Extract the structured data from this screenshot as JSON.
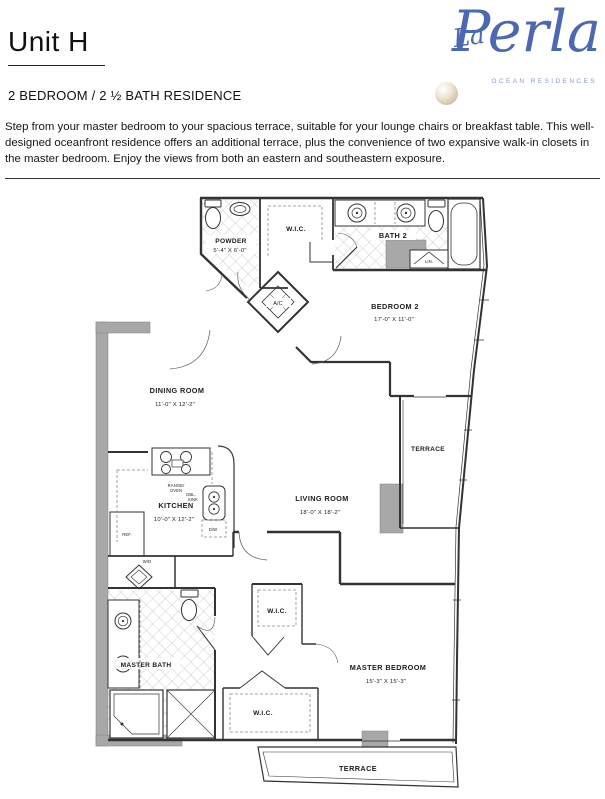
{
  "header": {
    "unit_title": "Unit H",
    "subtitle": "2 BEDROOM / 2 ½ BATH RESIDENCE",
    "description": "Step from your master bedroom to your spacious terrace, suitable for your lounge chairs or breakfast table. This well-designed oceanfront residence offers an additional terrace, plus the convenience of two expansive walk-in closets in the master bedroom. Enjoy the views from both an eastern and southeastern exposure."
  },
  "logo": {
    "script_la": "La",
    "script_perla": "Perla",
    "tagline": "OCEAN RESIDENCES",
    "brand_color": "#4c68b0",
    "pearl_color": "#d4c6b0"
  },
  "floorplan": {
    "rooms": {
      "powder": {
        "name": "POWDER",
        "dims": "5'-4\" X 6'-0\""
      },
      "wic_top": {
        "name": "W.I.C."
      },
      "bath2": {
        "name": "BATH 2"
      },
      "lin": {
        "name": "LIN."
      },
      "ac": {
        "name": "A/C"
      },
      "bedroom2": {
        "name": "BEDROOM 2",
        "dims": "17'-0\" X 11'-0\""
      },
      "dining": {
        "name": "DINING ROOM",
        "dims": "11'-0\" X 12'-2\""
      },
      "kitchen": {
        "name": "KITCHEN",
        "dims": "10'-0\" X 12'-2\""
      },
      "living": {
        "name": "LIVING ROOM",
        "dims": "18'-0\" X 18'-2\""
      },
      "terrace_east": {
        "name": "TERRACE"
      },
      "master_bath": {
        "name": "MASTER BATH"
      },
      "wd": {
        "name": "W/D"
      },
      "wic_upper": {
        "name": "W.I.C."
      },
      "wic_lower": {
        "name": "W.I.C."
      },
      "master_bedroom": {
        "name": "MASTER BEDROOM",
        "dims": "15'-3\" X 15'-3\""
      },
      "terrace_south": {
        "name": "TERRACE"
      }
    },
    "appliances": {
      "range1": "RANGE/",
      "range2": "OVEN",
      "ref": "REF.",
      "sink1": "DBL.",
      "sink2": "SINK",
      "dw": "D/W"
    }
  }
}
